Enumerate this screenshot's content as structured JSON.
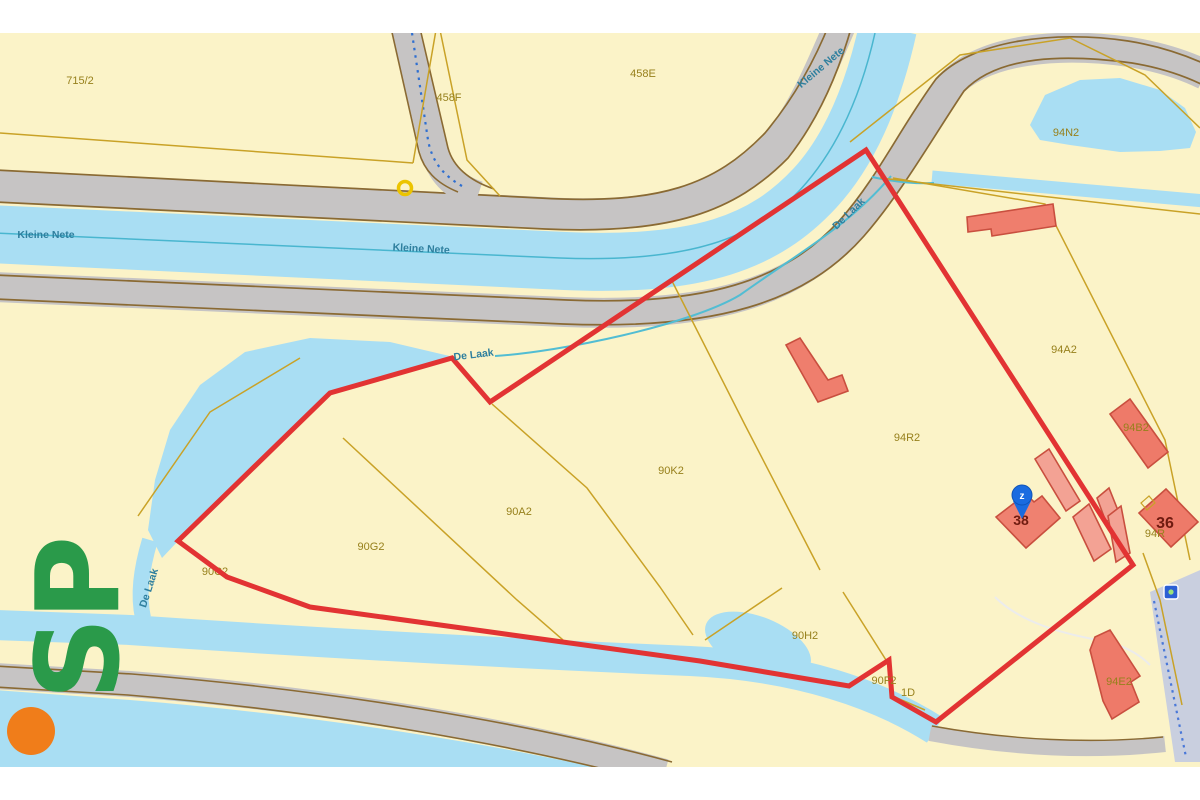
{
  "map": {
    "type": "cadastral-parcel-map",
    "selected_parcel_outline_color": "#e23333"
  },
  "labels": {
    "parcels": [
      {
        "text": "715/2"
      },
      {
        "text": "458F"
      },
      {
        "text": "458E"
      },
      {
        "text": "94N2"
      },
      {
        "text": "94A2"
      },
      {
        "text": "94R2"
      },
      {
        "text": "90K2"
      },
      {
        "text": "90A2"
      },
      {
        "text": "90G2"
      },
      {
        "text": "90C2"
      },
      {
        "text": "90H2"
      },
      {
        "text": "90F2"
      },
      {
        "text": "1D"
      },
      {
        "text": "94B2"
      },
      {
        "text": "94R"
      },
      {
        "text": "94E2"
      }
    ],
    "waters": [
      {
        "text": "Kleine Nete"
      },
      {
        "text": "Kleine Nete"
      },
      {
        "text": "Kleine Nete"
      },
      {
        "text": "De Laak"
      },
      {
        "text": "De Laak"
      },
      {
        "text": "De Laak"
      }
    ],
    "house_numbers": [
      {
        "text": "38"
      },
      {
        "text": "36"
      }
    ]
  },
  "pin": {
    "label": "z",
    "color": "#1a6be0"
  },
  "watermark": {
    "text": "SP",
    "green": "#2a9a4a",
    "orange": "#f07d1a"
  },
  "colors": {
    "parcel_fill": "#fbf3c8",
    "water": "#a9def3",
    "stream_line": "#49b6cf",
    "road_fill": "#c6c4c4",
    "road_edge": "#8a6a33",
    "parcel_line": "#c9a227",
    "building_fill": "#ef7e6d",
    "building_annex_fill": "#f3a294",
    "building_stroke": "#c94f3f",
    "boundary_red": "#e23333",
    "railway_fill": "#c9cfdf",
    "label_olive": "#97801c",
    "label_water": "#2e7f9e"
  }
}
